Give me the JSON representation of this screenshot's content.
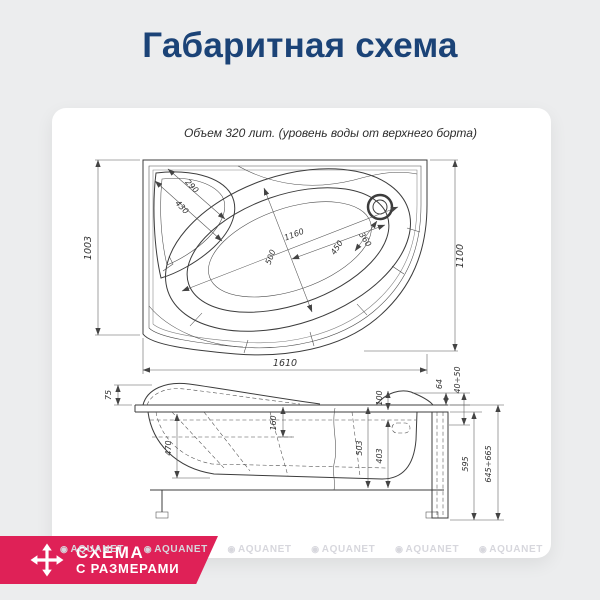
{
  "page": {
    "title": "Габаритная схема",
    "colors": {
      "background": "#ecedee",
      "title": "#1b4377",
      "accent": "#df2157",
      "drawing_line": "#3c3c3c",
      "watermark": "#d7d7dd"
    }
  },
  "drawing": {
    "caption": "Объем 320 лит. (уровень воды от верхнего борта)",
    "top_view": {
      "dims": {
        "side_left": "1003",
        "side_right": "1100",
        "length": "1610",
        "corner_width": "290",
        "corner_depth": "430",
        "basin_length": "1160",
        "basin_width": "500",
        "drain_distance": "450",
        "drain_zone": "360"
      }
    },
    "side_view": {
      "dims": {
        "headrest_height": "75",
        "bowl_depth": "470",
        "seat_height": "160",
        "shell_height": "503",
        "inner_height": "403",
        "rim_detail": "100",
        "edge_gap": "64",
        "feet_adjust": "40÷50",
        "apron_height": "595",
        "total_height": "645÷665"
      }
    }
  },
  "badge": {
    "line1": "СХЕМА",
    "line2": "С РАЗМЕРАМИ"
  },
  "watermark": {
    "icon": "◉",
    "text": "AQUANET"
  }
}
